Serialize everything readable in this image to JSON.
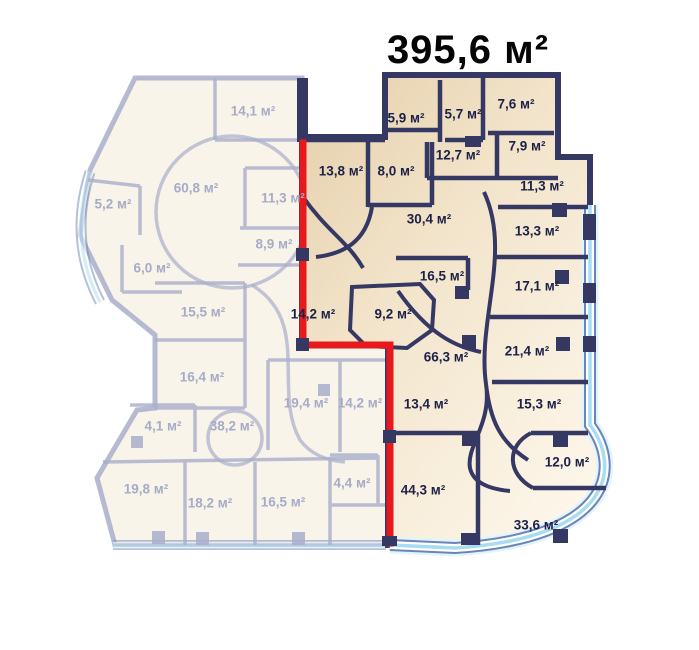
{
  "title": "395,6 м²",
  "units_suffix": "м²",
  "colors": {
    "wall_navy": "#353862",
    "red_outline": "#e8191d",
    "selected_fill_dark": "#e5cfab",
    "selected_fill_mid": "#f3e5cc",
    "selected_fill_light": "#fdf6ea",
    "faded_fill": "#f5ecdb",
    "faded_wall": "#a9aecb",
    "glass_blue": "#a8dcf0",
    "glass_edge": "#6a84b8",
    "selected_label_color": "#1c2148",
    "faded_label_color": "#a6abc7",
    "title_color": "#050505",
    "background": "#ffffff"
  },
  "rooms": {
    "highlighted": [
      {
        "area": "13,8 м²",
        "x": 341,
        "y": 171
      },
      {
        "area": "8,0 м²",
        "x": 396,
        "y": 171
      },
      {
        "area": "5,9 м²",
        "x": 406,
        "y": 118
      },
      {
        "area": "5,7 м²",
        "x": 463,
        "y": 114
      },
      {
        "area": "7,6 м²",
        "x": 516,
        "y": 104
      },
      {
        "area": "12,7 м²",
        "x": 458,
        "y": 155
      },
      {
        "area": "7,9 м²",
        "x": 527,
        "y": 146
      },
      {
        "area": "30,4 м²",
        "x": 429,
        "y": 219
      },
      {
        "area": "11,3 м²",
        "x": 542,
        "y": 186
      },
      {
        "area": "13,3 м²",
        "x": 537,
        "y": 231
      },
      {
        "area": "16,5 м²",
        "x": 442,
        "y": 276
      },
      {
        "area": "17,1 м²",
        "x": 537,
        "y": 286
      },
      {
        "area": "9,2 м²",
        "x": 393,
        "y": 314
      },
      {
        "area": "14,2 м²",
        "x": 313,
        "y": 314
      },
      {
        "area": "66,3 м²",
        "x": 446,
        "y": 357
      },
      {
        "area": "21,4 м²",
        "x": 527,
        "y": 351
      },
      {
        "area": "15,3 м²",
        "x": 539,
        "y": 404
      },
      {
        "area": "13,4 м²",
        "x": 426,
        "y": 404
      },
      {
        "area": "12,0 м²",
        "x": 567,
        "y": 462
      },
      {
        "area": "44,3 м²",
        "x": 423,
        "y": 490
      },
      {
        "area": "33,6 м²",
        "x": 536,
        "y": 525
      }
    ],
    "faded": [
      {
        "area": "14,1 м²",
        "x": 253,
        "y": 111
      },
      {
        "area": "60,8 м²",
        "x": 196,
        "y": 188
      },
      {
        "area": "5,2 м²",
        "x": 113,
        "y": 204
      },
      {
        "area": "11,3 м²",
        "x": 283,
        "y": 198
      },
      {
        "area": "8,9 м²",
        "x": 274,
        "y": 244
      },
      {
        "area": "6,0 м²",
        "x": 152,
        "y": 268
      },
      {
        "area": "15,5 м²",
        "x": 203,
        "y": 312
      },
      {
        "area": "16,4 м²",
        "x": 202,
        "y": 377
      },
      {
        "area": "4,1 м²",
        "x": 163,
        "y": 426
      },
      {
        "area": "38,2 м²",
        "x": 232,
        "y": 426
      },
      {
        "area": "19,4 м²",
        "x": 306,
        "y": 403
      },
      {
        "area": "14,2 м²",
        "x": 360,
        "y": 403
      },
      {
        "area": "19,8 м²",
        "x": 146,
        "y": 489
      },
      {
        "area": "18,2 м²",
        "x": 210,
        "y": 503
      },
      {
        "area": "16,5 м²",
        "x": 283,
        "y": 502
      },
      {
        "area": "4,4 м²",
        "x": 352,
        "y": 483
      }
    ]
  }
}
